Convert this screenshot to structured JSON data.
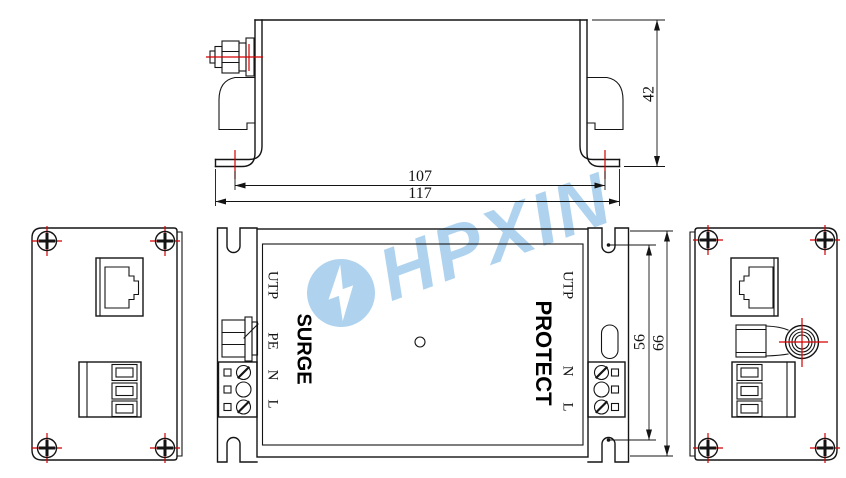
{
  "watermark": {
    "brand": "HPXIN"
  },
  "views": {
    "side": {
      "dim_height": "42",
      "dim_hole_spacing": "107",
      "dim_total_width": "117"
    },
    "plan": {
      "label_surge": "SURGE",
      "label_protect": "PROTECT",
      "label_utp_left": "UTP",
      "label_utp_right": "UTP",
      "label_pe": "PE",
      "label_n_left": "N",
      "label_l_left": "L",
      "label_n_right": "N",
      "label_l_right": "L",
      "dim_slot_spacing": "56",
      "dim_total_height": "66"
    }
  },
  "colors": {
    "line": "#141414",
    "centerline_red": "#d40000",
    "watermark_blue": "#afd3ee"
  }
}
